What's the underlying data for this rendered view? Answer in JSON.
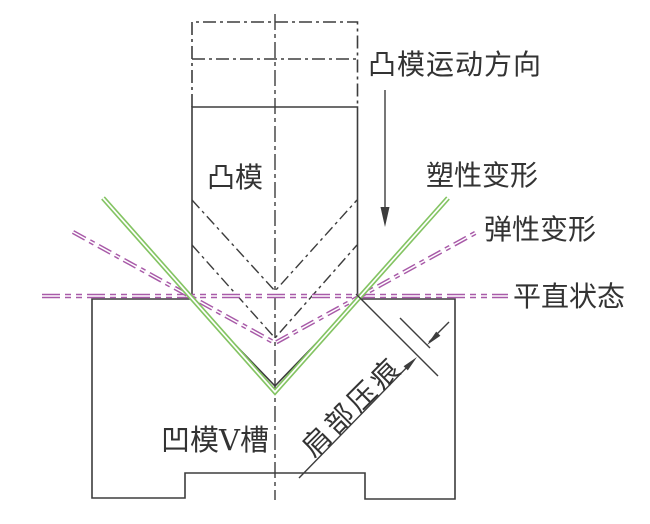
{
  "diagram": {
    "labels": {
      "punch_motion_direction": "凸模运动方向",
      "plastic_deformation": "塑性变形",
      "elastic_deformation": "弹性变形",
      "flat_state": "平直状态",
      "punch": "凸模",
      "die_v_groove": "凹模V槽",
      "shoulder_indentation": "肩部压痕"
    },
    "colors": {
      "line_black": "#3d3d3d",
      "plastic_green": "#84c463",
      "elastic_purple": "#a85aa8",
      "background": "#ffffff",
      "text_color": "#333333"
    }
  }
}
